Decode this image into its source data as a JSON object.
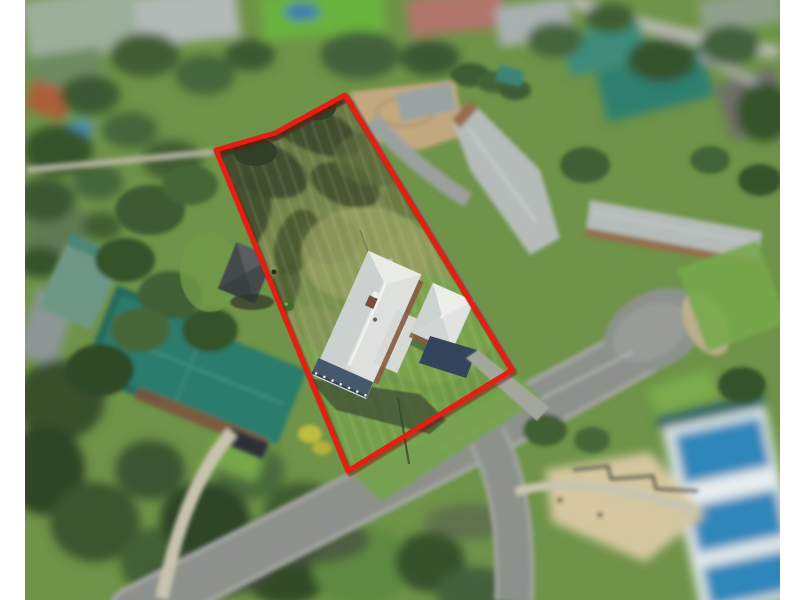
{
  "meta": {
    "description": "Aerial drone photograph of a residential property lot outlined in red, tilt-shift style, no visible text",
    "image_type": "real-estate-aerial-photo"
  },
  "frame": {
    "background": "#ffffff",
    "photo_x": 25,
    "photo_width": 755,
    "photo_y": 0,
    "photo_height": 600
  },
  "boundary": {
    "points": "345,95 275,133 216,150 348,471 512,370",
    "color": "#e81d12",
    "shadow_color": "#7d0d07",
    "stroke_width": "5"
  },
  "palette": {
    "base_green": "#6f9348",
    "lot_grass_dark": "#3d4b2d",
    "lot_grass_dry": "#9aa263",
    "lot_grass_bright": "#7ca64e",
    "road_gray": "#8d918c",
    "road_edge": "#a2a5a0",
    "footpath": "#c8c4b0",
    "roof_white": "#dde0dc",
    "roof_teal": "#2b7b6c",
    "roof_gray": "#b5bbb9",
    "roof_salmon": "#b1756b",
    "brick": "#8a5a43",
    "veranda_blue": "#46586b",
    "apron_blue": "#32455c",
    "blue_building": "#2f86ba",
    "dirt_tan": "#c2a87e",
    "tree_dark": "#3a552e",
    "shadow_green": "#3a4730"
  }
}
